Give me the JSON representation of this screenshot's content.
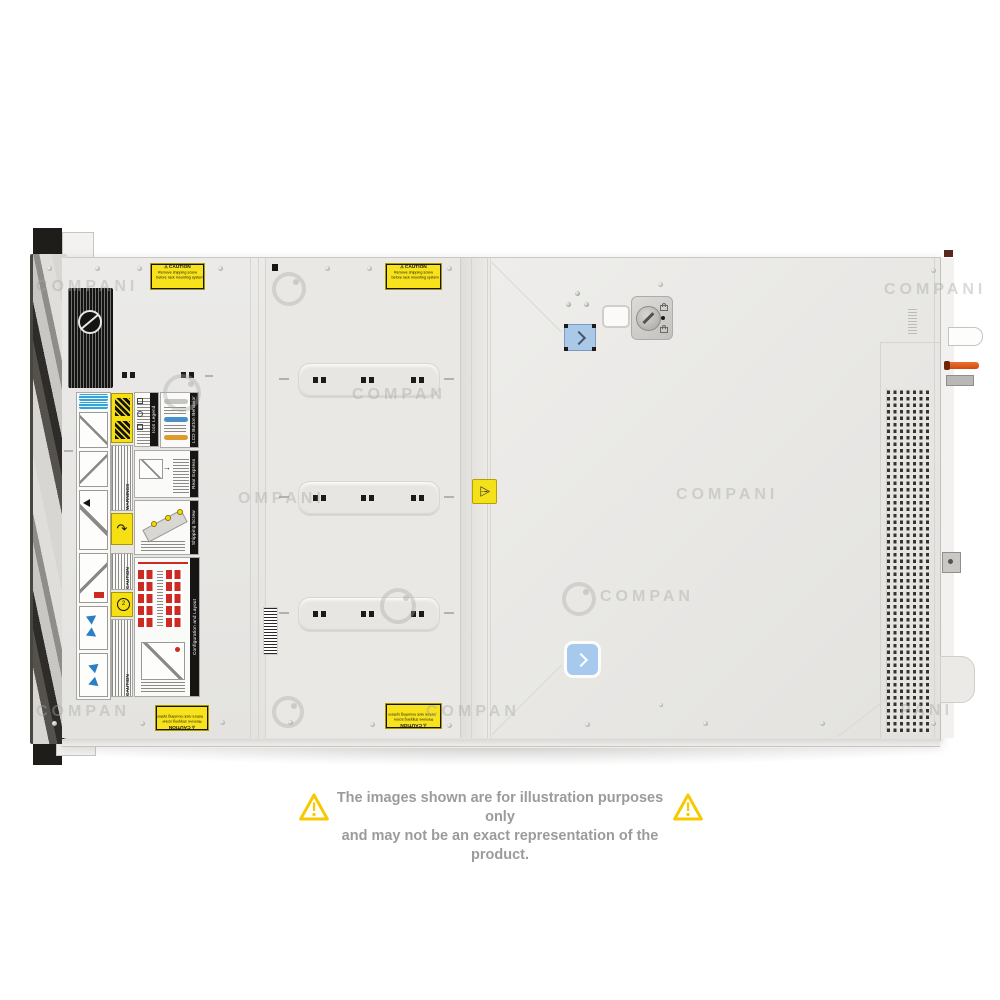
{
  "page": {
    "background": "#ffffff"
  },
  "watermarks": {
    "brand": "COMPANI",
    "brand_partial": "COMPAN",
    "brand_partial_left": "OMPANI",
    "brand_partial_right": "PANI"
  },
  "disclaimer": {
    "line1": "The images shown are for illustration purposes only",
    "line2": "and may not be an exact representation of the product.",
    "text_color": "#9b9b9b",
    "triangle_color": "#f6c900"
  },
  "server": {
    "caution_sticker": {
      "title": "CAUTION",
      "line1": "Remove shipping screw",
      "line2": "before rack mounting system"
    },
    "labels": {
      "icon_legend_title": "Icon Legend",
      "lcd_button_title": "LCD Button Behavior",
      "rear_tag_title": "Rear Express Service Tag",
      "shipping_screw_title": "Shipping Screw Removal",
      "config_layout_title": "Configuration and Layout",
      "warning_title": "WARNINGS",
      "caution_title": "CAUTION"
    },
    "colors": {
      "chassis": "#e8e7e4",
      "accent_blue": "#a7c9ed",
      "sticker_yellow": "#f6df12",
      "drive_red": "#cc2a22",
      "lever_orange": "#e55a1e"
    }
  }
}
